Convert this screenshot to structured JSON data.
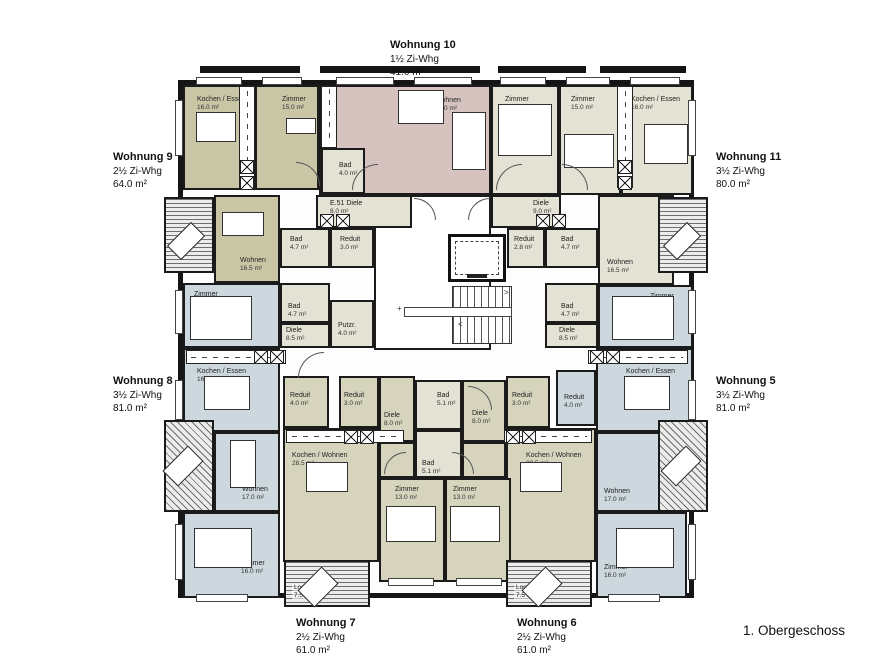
{
  "floor_label": "1. Obergeschoss",
  "colors": {
    "olive": "#c9c6a6",
    "cream": "#e4e2d4",
    "pink": "#d6c3c0",
    "blue": "#ccd7de",
    "lolive": "#d7d4bd",
    "white": "#ffffff",
    "wall": "#1b1b1b"
  },
  "building": {
    "x": 178,
    "y": 80,
    "w": 516,
    "h": 518
  },
  "apartments": [
    {
      "id": "wohnung-10",
      "name": "Wohnung 10",
      "type": "1½ Zi-Whg",
      "area": "41.0 m²",
      "x": 390,
      "y": 38
    },
    {
      "id": "wohnung-9",
      "name": "Wohnung 9",
      "type": "2½ Zi-Whg",
      "area": "64.0 m²",
      "x": 113,
      "y": 150
    },
    {
      "id": "wohnung-11",
      "name": "Wohnung 11",
      "type": "3½ Zi-Whg",
      "area": "80.0 m²",
      "x": 716,
      "y": 150
    },
    {
      "id": "wohnung-8",
      "name": "Wohnung 8",
      "type": "3½ Zi-Whg",
      "area": "81.0 m²",
      "x": 113,
      "y": 374
    },
    {
      "id": "wohnung-5",
      "name": "Wohnung 5",
      "type": "3½ Zi-Whg",
      "area": "81.0 m²",
      "x": 716,
      "y": 374
    },
    {
      "id": "wohnung-7",
      "name": "Wohnung 7",
      "type": "2½ Zi-Whg",
      "area": "61.0 m²",
      "x": 296,
      "y": 616
    },
    {
      "id": "wohnung-6",
      "name": "Wohnung 6",
      "type": "2½ Zi-Whg",
      "area": "61.0 m²",
      "x": 517,
      "y": 616
    }
  ],
  "rooms": [
    {
      "id": "w9-kochen-essen",
      "x": 183,
      "y": 85,
      "w": 72,
      "h": 105,
      "fill": "olive",
      "label": "Kochen / Essen",
      "area": "16.0 m²",
      "lx": 12,
      "ly": 9
    },
    {
      "id": "w9-zimmer",
      "x": 255,
      "y": 85,
      "w": 64,
      "h": 105,
      "fill": "olive",
      "label": "Zimmer",
      "area": "15.0 m²",
      "lx": 25,
      "ly": 9
    },
    {
      "id": "w10-wohnen",
      "x": 319,
      "y": 85,
      "w": 172,
      "h": 110,
      "fill": "pink",
      "label": "Wohnen",
      "area": "37.0 m²",
      "lx": 114,
      "ly": 10
    },
    {
      "id": "w10-bad",
      "x": 321,
      "y": 148,
      "w": 44,
      "h": 46,
      "fill": "cream",
      "label": "Bad",
      "area": "4.0 m²",
      "lx": 16,
      "ly": 12
    },
    {
      "id": "w11-zimmer-1",
      "x": 491,
      "y": 85,
      "w": 68,
      "h": 110,
      "fill": "cream",
      "label": "Zimmer",
      "area": "15.5 m²",
      "lx": 12,
      "ly": 9
    },
    {
      "id": "w11-zimmer-2",
      "x": 559,
      "y": 85,
      "w": 62,
      "h": 110,
      "fill": "cream",
      "label": "Zimmer",
      "area": "15.0 m²",
      "lx": 10,
      "ly": 9
    },
    {
      "id": "w11-kochen-essen",
      "x": 621,
      "y": 85,
      "w": 72,
      "h": 110,
      "fill": "cream",
      "label": "Kochen / Essen",
      "area": "16.0 m²",
      "lx": 8,
      "ly": 9
    },
    {
      "id": "stair-hall",
      "x": 374,
      "y": 195,
      "w": 117,
      "h": 155,
      "fill": "white",
      "label": "",
      "area": "",
      "lx": 0,
      "ly": 0
    },
    {
      "id": "e51-diele",
      "x": 316,
      "y": 195,
      "w": 96,
      "h": 33,
      "fill": "cream",
      "label": "E.51 Diele",
      "area": "8.0 m²",
      "lx": 12,
      "ly": 3
    },
    {
      "id": "w9-wohnen",
      "x": 214,
      "y": 195,
      "w": 66,
      "h": 88,
      "fill": "olive",
      "label": "Wohnen",
      "area": "16.5 m²",
      "lx": 24,
      "ly": 60
    },
    {
      "id": "w9-bad",
      "x": 280,
      "y": 228,
      "w": 50,
      "h": 40,
      "fill": "cream",
      "label": "Bad",
      "area": "4.7 m²",
      "lx": 8,
      "ly": 6
    },
    {
      "id": "w9-reduit",
      "x": 330,
      "y": 228,
      "w": 44,
      "h": 40,
      "fill": "cream",
      "label": "Reduit",
      "area": "3.0 m²",
      "lx": 8,
      "ly": 6
    },
    {
      "id": "w8-bad",
      "x": 280,
      "y": 283,
      "w": 50,
      "h": 40,
      "fill": "cream",
      "label": "Bad",
      "area": "4.7 m²",
      "lx": 6,
      "ly": 18
    },
    {
      "id": "w8-diele",
      "x": 280,
      "y": 323,
      "w": 50,
      "h": 25,
      "fill": "cream",
      "label": "Diele",
      "area": "8.5 m²",
      "lx": 4,
      "ly": 2
    },
    {
      "id": "putzraum",
      "x": 330,
      "y": 300,
      "w": 44,
      "h": 48,
      "fill": "cream",
      "label": "Putzr.",
      "area": "4.0 m²",
      "lx": 6,
      "ly": 20
    },
    {
      "id": "w8-zimmer-mitte",
      "x": 183,
      "y": 283,
      "w": 97,
      "h": 65,
      "fill": "blue",
      "label": "Zimmer",
      "area": "15.0 m²",
      "lx": 9,
      "ly": 6
    },
    {
      "id": "w11-diele",
      "x": 491,
      "y": 195,
      "w": 70,
      "h": 33,
      "fill": "cream",
      "label": "Diele",
      "area": "9.0 m²",
      "lx": 40,
      "ly": 3
    },
    {
      "id": "w11-reduit",
      "x": 507,
      "y": 228,
      "w": 38,
      "h": 40,
      "fill": "cream",
      "label": "Reduit",
      "area": "2.8 m²",
      "lx": 5,
      "ly": 6
    },
    {
      "id": "w11-bad",
      "x": 545,
      "y": 228,
      "w": 53,
      "h": 40,
      "fill": "cream",
      "label": "Bad",
      "area": "4.7 m²",
      "lx": 14,
      "ly": 6
    },
    {
      "id": "w11-wohnen",
      "x": 598,
      "y": 195,
      "w": 76,
      "h": 90,
      "fill": "cream",
      "label": "Wohnen",
      "area": "16.5 m²",
      "lx": 7,
      "ly": 62
    },
    {
      "id": "w5-bad-mitte",
      "x": 545,
      "y": 283,
      "w": 53,
      "h": 40,
      "fill": "cream",
      "label": "Bad",
      "area": "4.7 m²",
      "lx": 14,
      "ly": 18
    },
    {
      "id": "w5-diele-mitte",
      "x": 545,
      "y": 323,
      "w": 53,
      "h": 25,
      "fill": "cream",
      "label": "Diele",
      "area": "8.5 m²",
      "lx": 12,
      "ly": 2
    },
    {
      "id": "w5-zimmer-mitte",
      "x": 598,
      "y": 285,
      "w": 95,
      "h": 63,
      "fill": "blue",
      "label": "Zimmer",
      "area": "15.0 m²",
      "lx": 50,
      "ly": 6
    },
    {
      "id": "w8-kochen-essen",
      "x": 183,
      "y": 348,
      "w": 97,
      "h": 84,
      "fill": "blue",
      "label": "Kochen / Essen",
      "area": "16.0 m²",
      "lx": 12,
      "ly": 18
    },
    {
      "id": "w8-wohnen",
      "x": 214,
      "y": 432,
      "w": 66,
      "h": 80,
      "fill": "blue",
      "label": "Wohnen",
      "area": "17.0 m²",
      "lx": 26,
      "ly": 52
    },
    {
      "id": "w8-zimmer-unten",
      "x": 183,
      "y": 512,
      "w": 97,
      "h": 86,
      "fill": "blue",
      "label": "Zimmer",
      "area": "16.0 m²",
      "lx": 56,
      "ly": 46
    },
    {
      "id": "w5-kochen-essen",
      "x": 596,
      "y": 348,
      "w": 97,
      "h": 84,
      "fill": "blue",
      "label": "Kochen / Essen",
      "area": "16.0 m²",
      "lx": 28,
      "ly": 18
    },
    {
      "id": "w5-reduit",
      "x": 556,
      "y": 370,
      "w": 40,
      "h": 56,
      "fill": "blue",
      "label": "Reduit",
      "area": "4.0 m²",
      "lx": 6,
      "ly": 22
    },
    {
      "id": "w5-wohnen",
      "x": 596,
      "y": 432,
      "w": 66,
      "h": 80,
      "fill": "blue",
      "label": "Wohnen",
      "area": "17.0 m²",
      "lx": 6,
      "ly": 54
    },
    {
      "id": "w5-zimmer-unten",
      "x": 596,
      "y": 512,
      "w": 91,
      "h": 86,
      "fill": "blue",
      "label": "Zimmer",
      "area": "16.0 m²",
      "lx": 6,
      "ly": 50
    },
    {
      "id": "w7-reduit-4",
      "x": 283,
      "y": 376,
      "w": 46,
      "h": 52,
      "fill": "lolive",
      "label": "Reduit",
      "area": "4.0 m²",
      "lx": 5,
      "ly": 14
    },
    {
      "id": "w7-reduit-3",
      "x": 339,
      "y": 376,
      "w": 40,
      "h": 52,
      "fill": "lolive",
      "label": "Reduit",
      "area": "3.0 m²",
      "lx": 3,
      "ly": 14
    },
    {
      "id": "w7-diele",
      "x": 379,
      "y": 376,
      "w": 36,
      "h": 66,
      "fill": "lolive",
      "label": "Diele",
      "area": "8.0 m²",
      "lx": 3,
      "ly": 34
    },
    {
      "id": "w6-bad",
      "x": 415,
      "y": 380,
      "w": 47,
      "h": 50,
      "fill": "cream",
      "label": "Bad",
      "area": "5.1 m²",
      "lx": 20,
      "ly": 10
    },
    {
      "id": "w7-bad",
      "x": 415,
      "y": 430,
      "w": 47,
      "h": 48,
      "fill": "cream",
      "label": "Bad",
      "area": "5.1 m²",
      "lx": 5,
      "ly": 28
    },
    {
      "id": "w6-diele",
      "x": 462,
      "y": 380,
      "w": 44,
      "h": 62,
      "fill": "lolive",
      "label": "Diele",
      "area": "8.0 m²",
      "lx": 8,
      "ly": 28
    },
    {
      "id": "w6-reduit-3",
      "x": 506,
      "y": 376,
      "w": 44,
      "h": 52,
      "fill": "lolive",
      "label": "Reduit",
      "area": "3.0 m²",
      "lx": 4,
      "ly": 14
    },
    {
      "id": "w7-kochen-wohnen",
      "x": 283,
      "y": 428,
      "w": 96,
      "h": 134,
      "fill": "lolive",
      "label": "Kochen / Wohnen",
      "area": "28.5 m²",
      "lx": 7,
      "ly": 22
    },
    {
      "id": "w6-kochen-wohnen",
      "x": 506,
      "y": 428,
      "w": 90,
      "h": 134,
      "fill": "lolive",
      "label": "Kochen / Wohnen",
      "area": "28.5 m²",
      "lx": 18,
      "ly": 22
    },
    {
      "id": "w7-flur",
      "x": 379,
      "y": 442,
      "w": 36,
      "h": 36,
      "fill": "lolive",
      "label": "",
      "area": "",
      "lx": 0,
      "ly": 0
    },
    {
      "id": "w6-flur",
      "x": 462,
      "y": 442,
      "w": 44,
      "h": 36,
      "fill": "lolive",
      "label": "",
      "area": "",
      "lx": 0,
      "ly": 0
    },
    {
      "id": "w7-zimmer",
      "x": 379,
      "y": 478,
      "w": 66,
      "h": 104,
      "fill": "lolive",
      "label": "Zimmer",
      "area": "13.0 m²",
      "lx": 14,
      "ly": 6
    },
    {
      "id": "w6-zimmer",
      "x": 445,
      "y": 478,
      "w": 66,
      "h": 104,
      "fill": "lolive",
      "label": "Zimmer",
      "area": "13.0 m²",
      "lx": 6,
      "ly": 6
    }
  ],
  "balconies": [
    {
      "id": "balkon-links-oben",
      "x": 164,
      "y": 197,
      "w": 50,
      "h": 76,
      "hatch": "h",
      "label": "",
      "area": ""
    },
    {
      "id": "balkon-rechts-oben",
      "x": 658,
      "y": 197,
      "w": 50,
      "h": 76,
      "hatch": "h",
      "label": "",
      "area": ""
    },
    {
      "id": "balkon-links-unten",
      "x": 164,
      "y": 420,
      "w": 50,
      "h": 92,
      "hatch": "d",
      "label": "",
      "area": ""
    },
    {
      "id": "balkon-rechts-unten",
      "x": 658,
      "y": 420,
      "w": 50,
      "h": 92,
      "hatch": "d",
      "label": "",
      "area": ""
    },
    {
      "id": "loggia-wohnung-7",
      "x": 284,
      "y": 560,
      "w": 86,
      "h": 47,
      "hatch": "h",
      "label": "Loggia",
      "area": "7.5 m²"
    },
    {
      "id": "loggia-wohnung-6",
      "x": 506,
      "y": 560,
      "w": 86,
      "h": 47,
      "hatch": "h",
      "label": "Loggia",
      "area": "7.5 m²"
    }
  ],
  "counters": [
    {
      "x": 239,
      "y": 86,
      "w": 16,
      "h": 102,
      "o": "v"
    },
    {
      "x": 321,
      "y": 86,
      "w": 16,
      "h": 62,
      "o": "v"
    },
    {
      "x": 617,
      "y": 86,
      "w": 16,
      "h": 102,
      "o": "v"
    },
    {
      "x": 186,
      "y": 350,
      "w": 100,
      "h": 14,
      "o": "h"
    },
    {
      "x": 588,
      "y": 350,
      "w": 100,
      "h": 14,
      "o": "h"
    },
    {
      "x": 286,
      "y": 430,
      "w": 118,
      "h": 13,
      "o": "h"
    },
    {
      "x": 504,
      "y": 430,
      "w": 88,
      "h": 13,
      "o": "h"
    }
  ],
  "xboxes": [
    {
      "x": 240,
      "y": 160
    },
    {
      "x": 240,
      "y": 176
    },
    {
      "x": 618,
      "y": 160
    },
    {
      "x": 618,
      "y": 176
    },
    {
      "x": 320,
      "y": 214
    },
    {
      "x": 336,
      "y": 214
    },
    {
      "x": 536,
      "y": 214
    },
    {
      "x": 552,
      "y": 214
    },
    {
      "x": 254,
      "y": 350
    },
    {
      "x": 270,
      "y": 350
    },
    {
      "x": 590,
      "y": 350
    },
    {
      "x": 606,
      "y": 350
    },
    {
      "x": 344,
      "y": 430
    },
    {
      "x": 360,
      "y": 430
    },
    {
      "x": 506,
      "y": 430
    },
    {
      "x": 522,
      "y": 430
    }
  ],
  "stairs": {
    "treads": {
      "x": 452,
      "y": 286,
      "w": 60,
      "h": 58
    },
    "landing": {
      "x": 404,
      "y": 307,
      "w": 108,
      "h": 10
    },
    "lift": {
      "x": 448,
      "y": 234,
      "w": 58,
      "h": 48
    }
  },
  "windows": [
    {
      "x": 196,
      "y": 77,
      "w": 46,
      "h": 8
    },
    {
      "x": 262,
      "y": 77,
      "w": 40,
      "h": 8
    },
    {
      "x": 336,
      "y": 77,
      "w": 58,
      "h": 8
    },
    {
      "x": 414,
      "y": 77,
      "w": 58,
      "h": 8
    },
    {
      "x": 500,
      "y": 77,
      "w": 46,
      "h": 8
    },
    {
      "x": 566,
      "y": 77,
      "w": 44,
      "h": 8
    },
    {
      "x": 630,
      "y": 77,
      "w": 50,
      "h": 8
    },
    {
      "x": 175,
      "y": 100,
      "w": 8,
      "h": 56
    },
    {
      "x": 175,
      "y": 290,
      "w": 8,
      "h": 44
    },
    {
      "x": 175,
      "y": 380,
      "w": 8,
      "h": 40
    },
    {
      "x": 175,
      "y": 524,
      "w": 8,
      "h": 56
    },
    {
      "x": 688,
      "y": 100,
      "w": 8,
      "h": 56
    },
    {
      "x": 688,
      "y": 290,
      "w": 8,
      "h": 44
    },
    {
      "x": 688,
      "y": 380,
      "w": 8,
      "h": 40
    },
    {
      "x": 688,
      "y": 524,
      "w": 8,
      "h": 56
    },
    {
      "x": 196,
      "y": 594,
      "w": 52,
      "h": 8
    },
    {
      "x": 608,
      "y": 594,
      "w": 52,
      "h": 8
    },
    {
      "x": 388,
      "y": 578,
      "w": 46,
      "h": 8
    },
    {
      "x": 456,
      "y": 578,
      "w": 46,
      "h": 8
    }
  ],
  "slabs": [
    {
      "x": 200,
      "y": 66,
      "w": 100,
      "h": 7
    },
    {
      "x": 320,
      "y": 66,
      "w": 160,
      "h": 7
    },
    {
      "x": 498,
      "y": 66,
      "w": 88,
      "h": 7
    },
    {
      "x": 600,
      "y": 66,
      "w": 86,
      "h": 7
    }
  ],
  "furniture": [
    {
      "t": "rect",
      "x": 196,
      "y": 112,
      "w": 40,
      "h": 30
    },
    {
      "t": "rect",
      "x": 286,
      "y": 118,
      "w": 30,
      "h": 16
    },
    {
      "t": "rect",
      "x": 398,
      "y": 90,
      "w": 46,
      "h": 34
    },
    {
      "t": "rect",
      "x": 452,
      "y": 112,
      "w": 34,
      "h": 58
    },
    {
      "t": "rect",
      "x": 498,
      "y": 104,
      "w": 54,
      "h": 52
    },
    {
      "t": "rect",
      "x": 564,
      "y": 134,
      "w": 50,
      "h": 34
    },
    {
      "t": "rect",
      "x": 644,
      "y": 124,
      "w": 44,
      "h": 40
    },
    {
      "t": "rect",
      "x": 222,
      "y": 212,
      "w": 42,
      "h": 24
    },
    {
      "t": "rect",
      "x": 190,
      "y": 296,
      "w": 62,
      "h": 44
    },
    {
      "t": "rect",
      "x": 612,
      "y": 296,
      "w": 62,
      "h": 44
    },
    {
      "t": "rect",
      "x": 204,
      "y": 376,
      "w": 46,
      "h": 34
    },
    {
      "t": "rect",
      "x": 624,
      "y": 376,
      "w": 46,
      "h": 34
    },
    {
      "t": "rect",
      "x": 230,
      "y": 440,
      "w": 26,
      "h": 48
    },
    {
      "t": "rect",
      "x": 194,
      "y": 528,
      "w": 58,
      "h": 40
    },
    {
      "t": "rect",
      "x": 616,
      "y": 528,
      "w": 58,
      "h": 40
    },
    {
      "t": "rect",
      "x": 306,
      "y": 462,
      "w": 42,
      "h": 30
    },
    {
      "t": "rect",
      "x": 520,
      "y": 462,
      "w": 42,
      "h": 30
    },
    {
      "t": "rect",
      "x": 386,
      "y": 506,
      "w": 50,
      "h": 36
    },
    {
      "t": "rect",
      "x": 450,
      "y": 506,
      "w": 50,
      "h": 36
    },
    {
      "t": "lounger",
      "x": 176,
      "y": 224,
      "w": 20,
      "h": 34
    },
    {
      "t": "lounger",
      "x": 672,
      "y": 224,
      "w": 20,
      "h": 34
    },
    {
      "t": "lounger",
      "x": 172,
      "y": 448,
      "w": 22,
      "h": 36
    },
    {
      "t": "lounger",
      "x": 670,
      "y": 448,
      "w": 22,
      "h": 36
    },
    {
      "t": "lounger",
      "x": 306,
      "y": 570,
      "w": 24,
      "h": 34
    },
    {
      "t": "lounger",
      "x": 530,
      "y": 570,
      "w": 24,
      "h": 34
    }
  ],
  "doors": [
    {
      "x": 352,
      "y": 164,
      "s": 26,
      "r": 0
    },
    {
      "x": 414,
      "y": 198,
      "s": 22,
      "r": 90
    },
    {
      "x": 468,
      "y": 198,
      "s": 22,
      "r": 0
    },
    {
      "x": 296,
      "y": 162,
      "s": 24,
      "r": 90
    },
    {
      "x": 496,
      "y": 164,
      "s": 26,
      "r": 0
    },
    {
      "x": 562,
      "y": 164,
      "s": 26,
      "r": 90
    },
    {
      "x": 298,
      "y": 352,
      "s": 26,
      "r": 0
    },
    {
      "x": 468,
      "y": 386,
      "s": 24,
      "r": 90
    },
    {
      "x": 384,
      "y": 452,
      "s": 22,
      "r": 0
    },
    {
      "x": 452,
      "y": 452,
      "s": 22,
      "r": 90
    }
  ],
  "annotations": [
    {
      "t": "+",
      "x": 397,
      "y": 304
    },
    {
      "t": ">",
      "x": 504,
      "y": 288
    },
    {
      "t": "<",
      "x": 458,
      "y": 320
    }
  ]
}
